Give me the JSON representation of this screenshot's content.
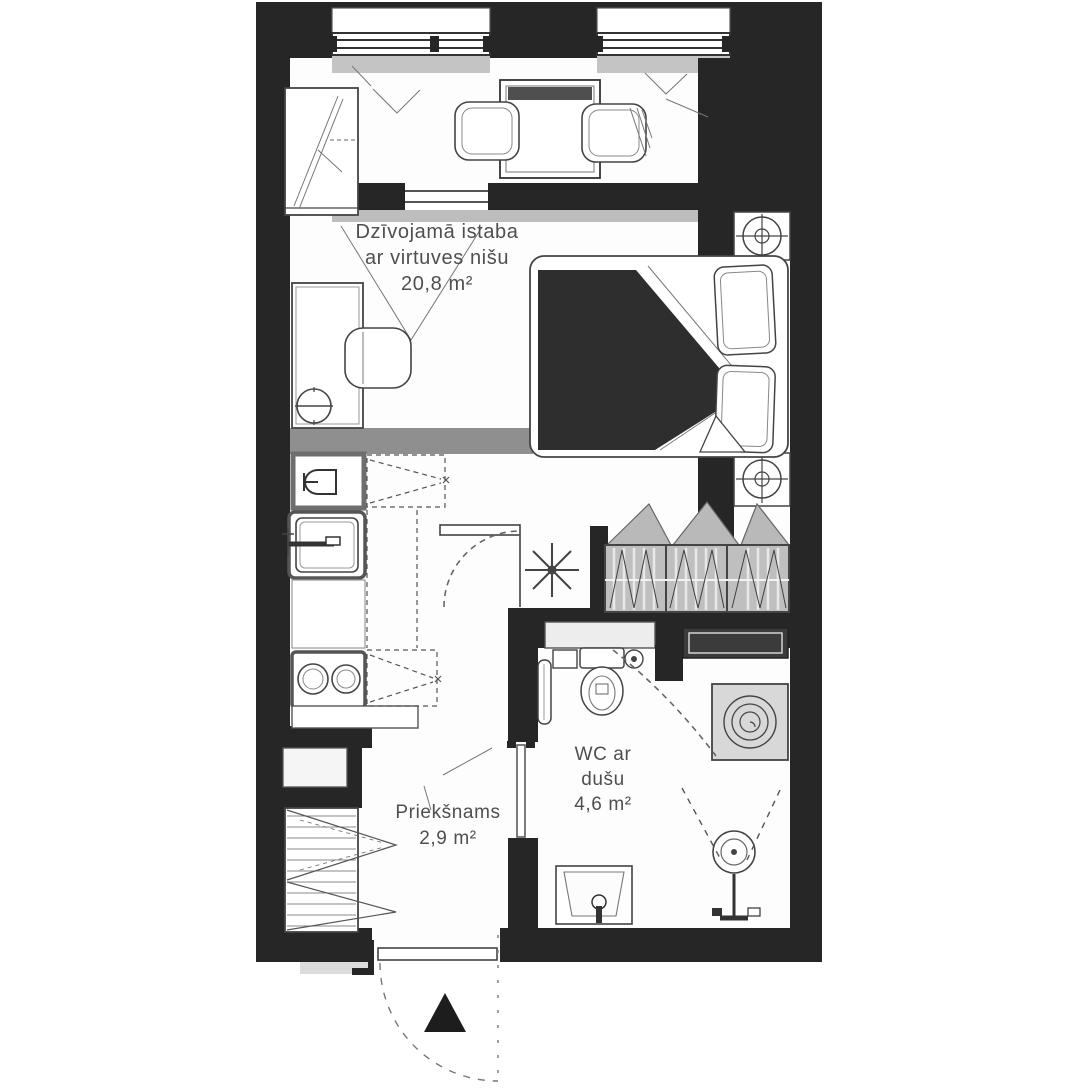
{
  "plan_title": "Apartment floor plan",
  "rooms": {
    "living": {
      "line1": "Dzīvojamā istaba",
      "line2": "ar virtuves nišu",
      "area": "20,8 m²"
    },
    "bathroom": {
      "line1": "WC ar",
      "line2": "dušu",
      "area": "4,6 m²"
    },
    "hallway": {
      "line1": "Priekšnams",
      "area": "2,9 m²"
    }
  },
  "colors": {
    "wall": "#262626",
    "floor": "#ffffff",
    "furniture_line": "#444444",
    "gray_band": "#8f8f8f",
    "sill_gray": "#c4c4c4",
    "wardrobe_fill": "#bfbfbf",
    "blanket_dark": "#2e2e2e",
    "shelf_dark": "#3b3b3b",
    "label_text": "#4f4f4f"
  }
}
